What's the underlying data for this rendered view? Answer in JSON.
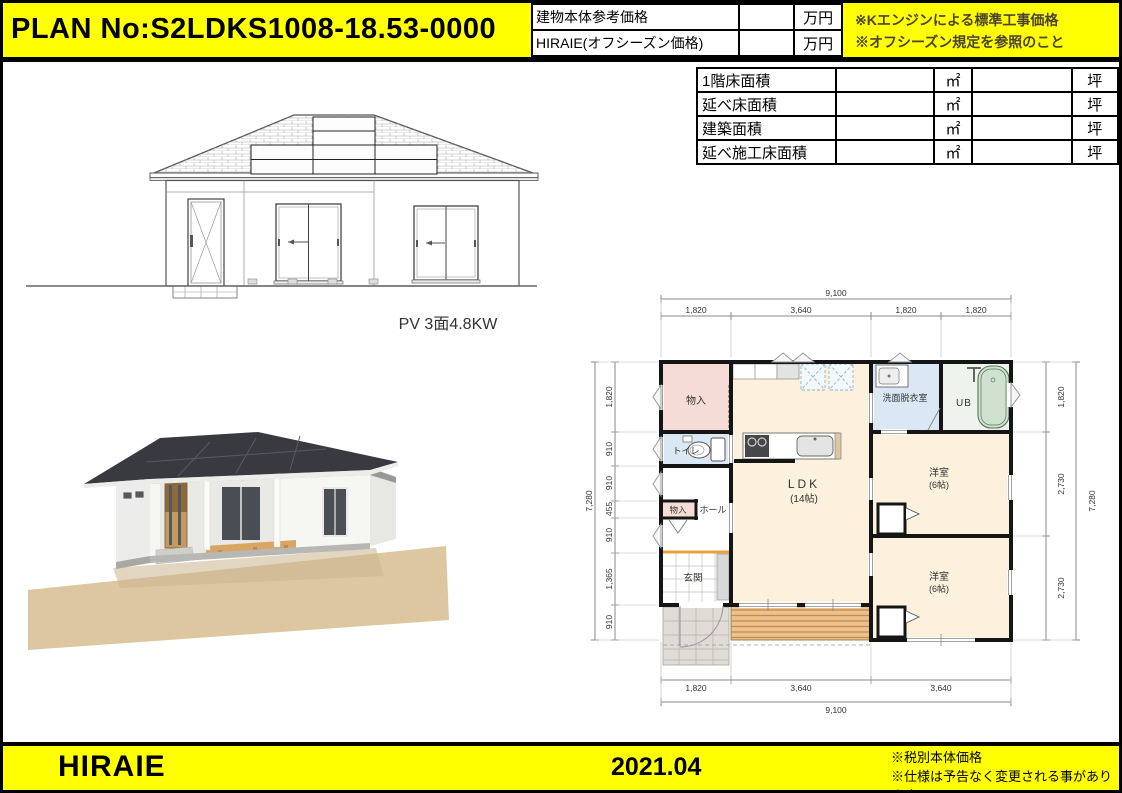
{
  "header": {
    "plan_no": "PLAN No:S2LDKS1008-18.53-0000",
    "price_rows": [
      {
        "label": "建物本体参考価格",
        "value": "",
        "unit": "万円"
      },
      {
        "label": "HIRAIE(オフシーズン価格)",
        "value": "",
        "unit": "万円"
      }
    ],
    "notes": [
      "※Kエンジンによる標準工事価格",
      "※オフシーズン規定を参照のこと"
    ]
  },
  "area_table": {
    "rows": [
      {
        "label": "1階床面積",
        "value_m2": "",
        "unit_m2": "㎡",
        "value_tsubo": "",
        "unit_tsubo": "坪"
      },
      {
        "label": "延べ床面積",
        "value_m2": "",
        "unit_m2": "㎡",
        "value_tsubo": "",
        "unit_tsubo": "坪"
      },
      {
        "label": "建築面積",
        "value_m2": "",
        "unit_m2": "㎡",
        "value_tsubo": "",
        "unit_tsubo": "坪"
      },
      {
        "label": "延べ施工床面積",
        "value_m2": "",
        "unit_m2": "㎡",
        "value_tsubo": "",
        "unit_tsubo": "坪"
      }
    ]
  },
  "elevation": {
    "caption": "PV 3面4.8KW"
  },
  "floor_plan": {
    "dim_top_overall": "9,100",
    "dim_top_segments": [
      "1,820",
      "3,640",
      "1,820",
      "1,820"
    ],
    "dim_bottom_segments": [
      "1,820",
      "3,640",
      "3,640"
    ],
    "dim_bottom_overall": "9,100",
    "dim_left_overall": "7,280",
    "dim_left_segments": [
      "1,820",
      "910",
      "910",
      "455",
      "910",
      "1,365",
      "910"
    ],
    "dim_right_segments": [
      "1,820",
      "2,730",
      "2,730"
    ],
    "dim_right_overall": "7,280",
    "rooms": {
      "storage_top": "物入",
      "toilet": "トイレ",
      "storage_small": "物入",
      "hall": "ホール",
      "entrance": "玄関",
      "ldk": "LDK",
      "ldk_size": "(14帖)",
      "washroom": "洗面脱衣室",
      "bath": "UB",
      "bedroom1": "洋室",
      "bedroom1_size": "(6帖)",
      "bedroom2": "洋室",
      "bedroom2_size": "(6帖)"
    }
  },
  "footer": {
    "brand": "HIRAIE",
    "date": "2021.04",
    "notes": [
      "※税別本体価格",
      "※仕様は予告なく変更される事があります。"
    ]
  },
  "colors": {
    "accent_yellow": "#ffff00",
    "wall_black": "#151515",
    "ldk_cream": "#fbf1dc",
    "storage_pink": "#f6dcd6",
    "wet_area_blue": "#d9e8f4",
    "tub_green": "#cfe2cf",
    "deck_orange": "#ecc18c",
    "genkan_step_orange": "#e8a23c",
    "roof_dark": "#393a40",
    "ground_tan": "#dcc7a1"
  }
}
